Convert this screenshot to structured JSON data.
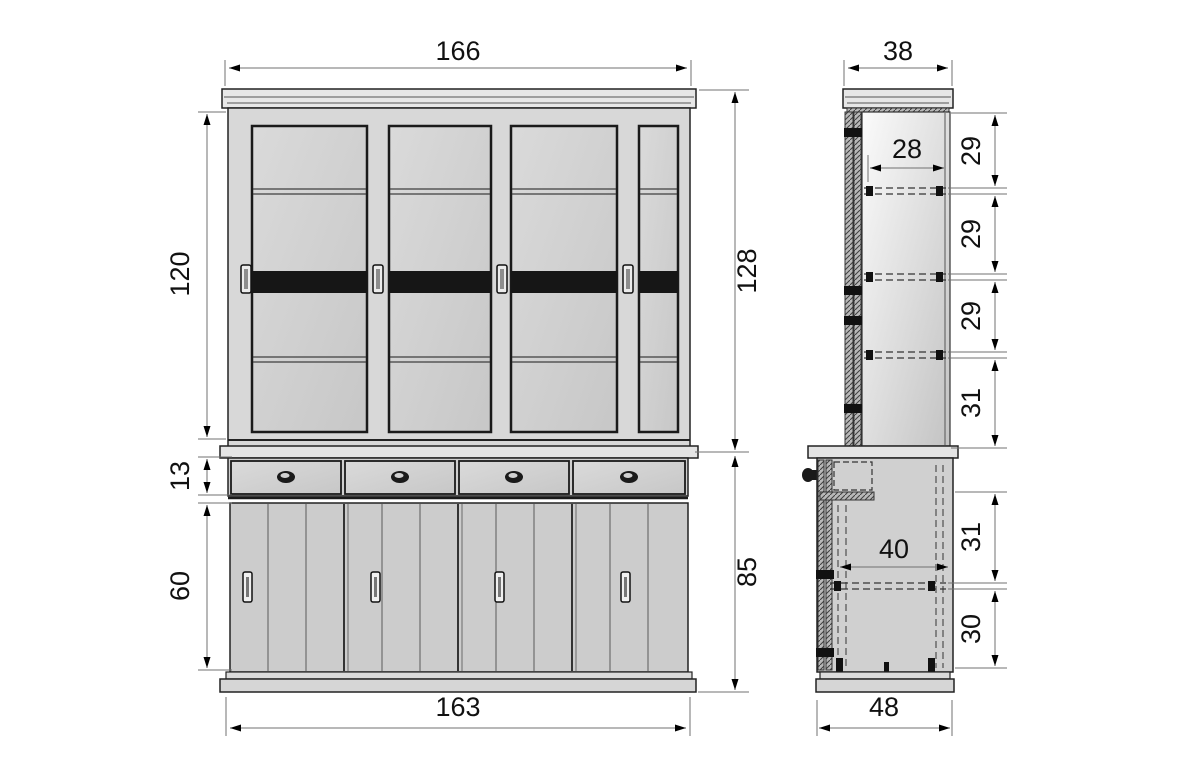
{
  "diagram": {
    "type": "furniture technical drawing",
    "subject": "buffet display cabinet, front and side elevation with dimensions",
    "unit_hint": "cm (implied)",
    "colors": {
      "background": "#ffffff",
      "outline": "#222222",
      "panel_fill": "#d6d6d6",
      "dark_band": "#1c1c1c",
      "dimension_line": "#707070",
      "text": "#111111"
    },
    "front_view": {
      "name": "front elevation",
      "dims": {
        "width_top": "166",
        "height_upper_doors": "120",
        "height_upper_total": "128",
        "height_drawers": "13",
        "height_lower_doors": "60",
        "height_lower_total": "85",
        "width_base": "163"
      }
    },
    "side_view": {
      "name": "side elevation",
      "dims": {
        "depth_top": "38",
        "inner_depth_upper": "28",
        "shelf_gap_1": "29",
        "shelf_gap_2": "29",
        "shelf_gap_3": "29",
        "shelf_gap_4": "31",
        "inner_depth_lower": "40",
        "shelf_gap_5": "31",
        "shelf_gap_6": "30",
        "depth_base": "48"
      }
    }
  }
}
